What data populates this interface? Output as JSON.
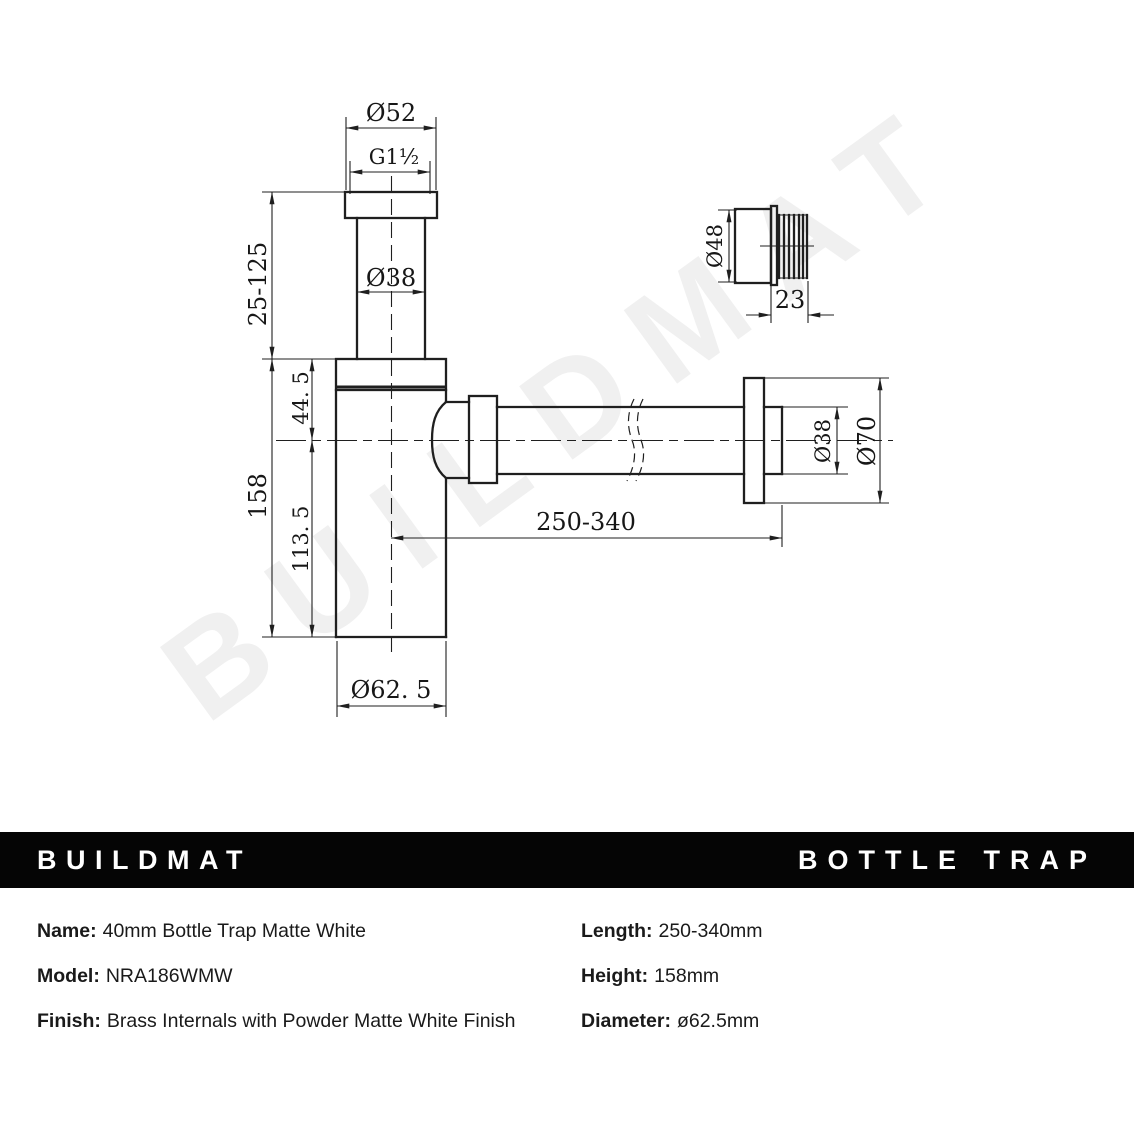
{
  "watermark": "BUILDMAT",
  "header": {
    "brand": "BUILDMAT",
    "product": "BOTTLE TRAP"
  },
  "drawing": {
    "dims": {
      "top_flange_diameter": "Ø52",
      "thread_size": "G1½",
      "inlet_diameter": "Ø38",
      "inlet_height_range": "25-125",
      "upper_height": "44. 5",
      "total_height": "158",
      "lower_height": "113. 5",
      "outlet_length_range": "250-340",
      "outlet_pipe_diameter": "Ø38",
      "wall_flange_diameter": "Ø70",
      "body_diameter": "Ø62. 5",
      "adapter_diameter": "Ø48",
      "adapter_thread_length": "23"
    }
  },
  "specs": {
    "left": [
      {
        "label": "Name:",
        "value": "40mm Bottle Trap Matte White"
      },
      {
        "label": "Model:",
        "value": "NRA186WMW"
      },
      {
        "label": "Finish:",
        "value": "Brass Internals with Powder Matte White Finish"
      }
    ],
    "right": [
      {
        "label": "Length:",
        "value": "250-340mm"
      },
      {
        "label": "Height:",
        "value": "158mm"
      },
      {
        "label": "Diameter:",
        "value": "ø62.5mm"
      }
    ]
  }
}
